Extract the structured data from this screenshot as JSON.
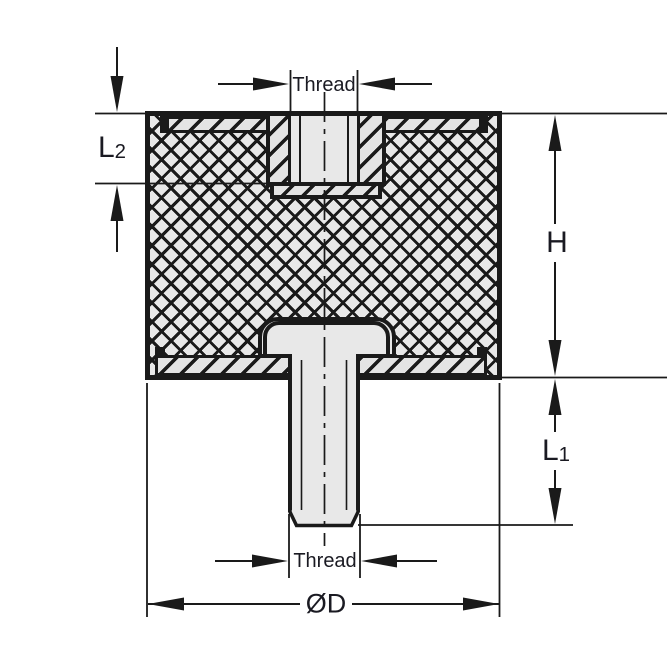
{
  "diagram": {
    "type": "technical-section-drawing",
    "subject": "rubber-bobbin-vibration-mount",
    "labels": {
      "thread_top": "Thread",
      "thread_bottom": "Thread",
      "h": "H",
      "l1_main": "L",
      "l1_sub": "1",
      "l2_main": "L",
      "l2_sub": "2",
      "diameter": "ØD"
    },
    "colors": {
      "line": "#1a1a1a",
      "fill_light": "#e8e8e8",
      "background": "#ffffff",
      "text": "#1a1a22"
    }
  }
}
